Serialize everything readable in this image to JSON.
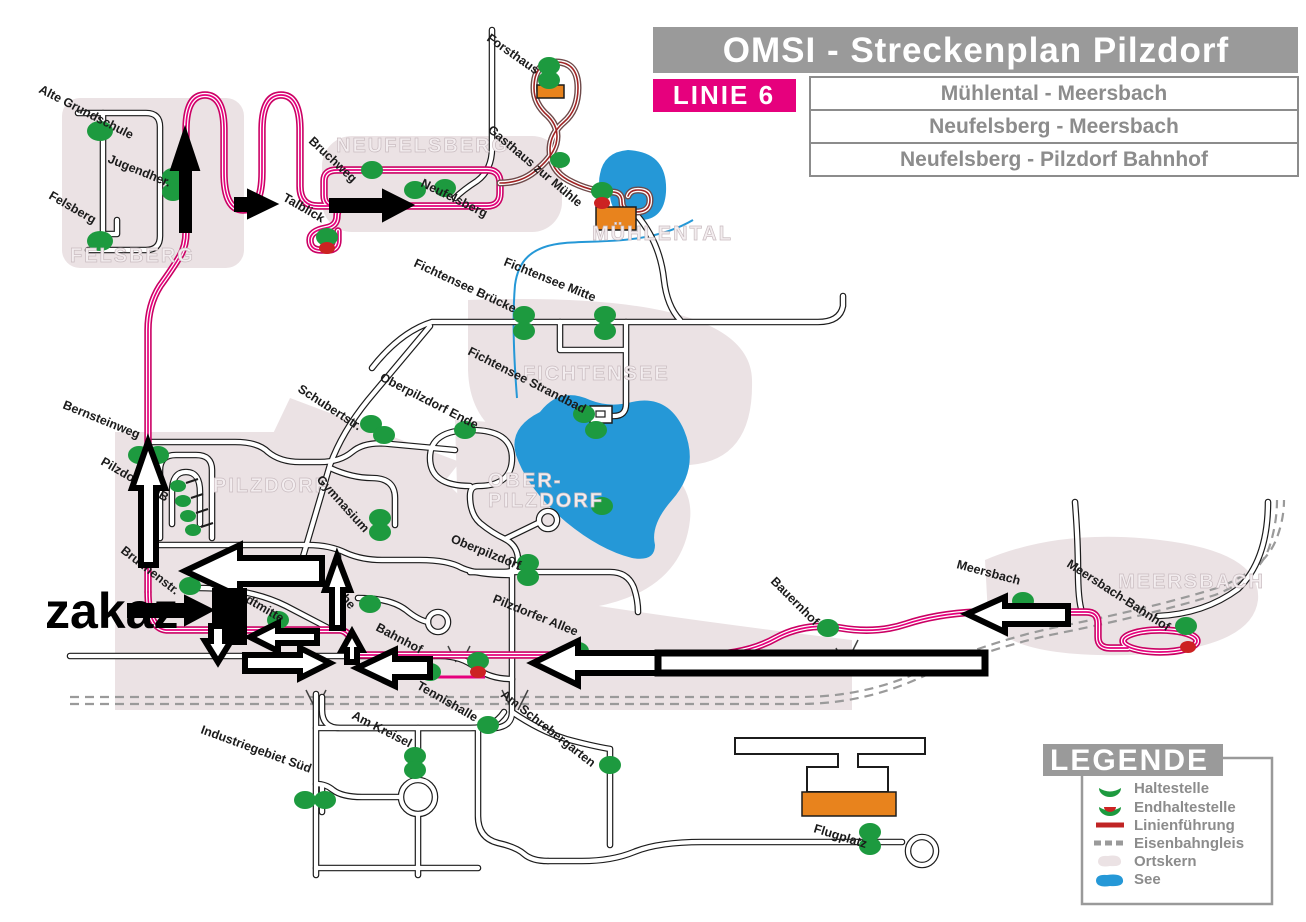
{
  "header": {
    "title": "OMSI - Streckenplan Pilzdorf",
    "line_badge": "LINIE  6",
    "routes": [
      "Mühlental - Meersbach",
      "Neufelsberg - Meersbach",
      "Neufelsberg - Pilzdorf Bahnhof"
    ]
  },
  "legend": {
    "title": "LEGENDE",
    "items": [
      {
        "label": "Haltestelle",
        "symbol": "stop-half-circle",
        "color": "#1d9a3f"
      },
      {
        "label": "Endhaltestelle",
        "symbol": "terminal-half-circle",
        "color": "#cc2222"
      },
      {
        "label": "Linienführung",
        "symbol": "route-line",
        "color": "#c02424"
      },
      {
        "label": "Eisenbahngleis",
        "symbol": "railway-dashed-line",
        "color": "#9a9a9a"
      },
      {
        "label": "Ortskern",
        "symbol": "town-core-blob",
        "color": "#ebe2e4"
      },
      {
        "label": "See",
        "symbol": "lake-blob",
        "color": "#2598d7"
      }
    ]
  },
  "annotation": {
    "text": "zakaz"
  },
  "areas": {
    "felsberg": "FELSBERG",
    "neufelsberg": "NEUFELSBERG",
    "muehlental": "MÜHLENTAL",
    "fichtensee": "FICHTENSEE",
    "pilzdorf": "PILZDORF",
    "oberpilzdorf_line1": "OBER-",
    "oberpilzdorf_line2": "PILZDORF",
    "meersbach": "MEERSBACH"
  },
  "stops": {
    "alte_grundschule": "Alte Grundschule",
    "jugendherberge": "Jugendher.",
    "felsberg": "Felsberg",
    "forsthaus": "Forsthaus",
    "bruchweg": "Bruchweg",
    "talblick": "Talblick",
    "neufelsberg": "Neufelsberg",
    "gasthaus_zur_muehle": "Gasthaus zur Mühle",
    "fichtensee_bruecke": "Fichtensee Brücke",
    "fichtensee_mitte": "Fichtensee Mitte",
    "fichtensee_strandbad": "Fichtensee Strandbad",
    "oberpilzdorf_ende": "Oberpilzdorf Ende",
    "schubertstr": "Schubertstr.",
    "bernsteinweg": "Bernsteinweg",
    "pilzdorf_zob": "Pilzdorf ZOB",
    "gymnasium": "Gymnasium",
    "oberpilzdorf": "Oberpilzdorf",
    "brunnenstr": "Brunnenstr.",
    "stadtmitte": "Stadtmitte",
    "kirche": "Kirche",
    "bahnhof": "Bahnhof",
    "pilzdorfer_allee": "Pilzdorfer Allee",
    "tennishalle": "Tennishalle",
    "am_schrebergarten": "Am Schrebergarten",
    "am_kreisel": "Am Kreisel",
    "industriegebiet_sued": "Industriegebiet Süd",
    "bauernhof": "Bauernhof",
    "meersbach": "Meersbach",
    "meersbach_bahnhof": "Meersbach-Bahnhof",
    "flugplatz": "Flugplatz"
  },
  "colors": {
    "line_badge_bg": "#e6007d",
    "header_bg": "#9a9a9a",
    "route_line": "#e6007d",
    "route_branch": "#a02424",
    "stop_green": "#1d9a3f",
    "terminal_red": "#cc2222",
    "lake_blue": "#2598d7",
    "town_core": "#ebe2e4",
    "railway_gray": "#9a9a9a",
    "terminal_orange": "#e8831d"
  }
}
